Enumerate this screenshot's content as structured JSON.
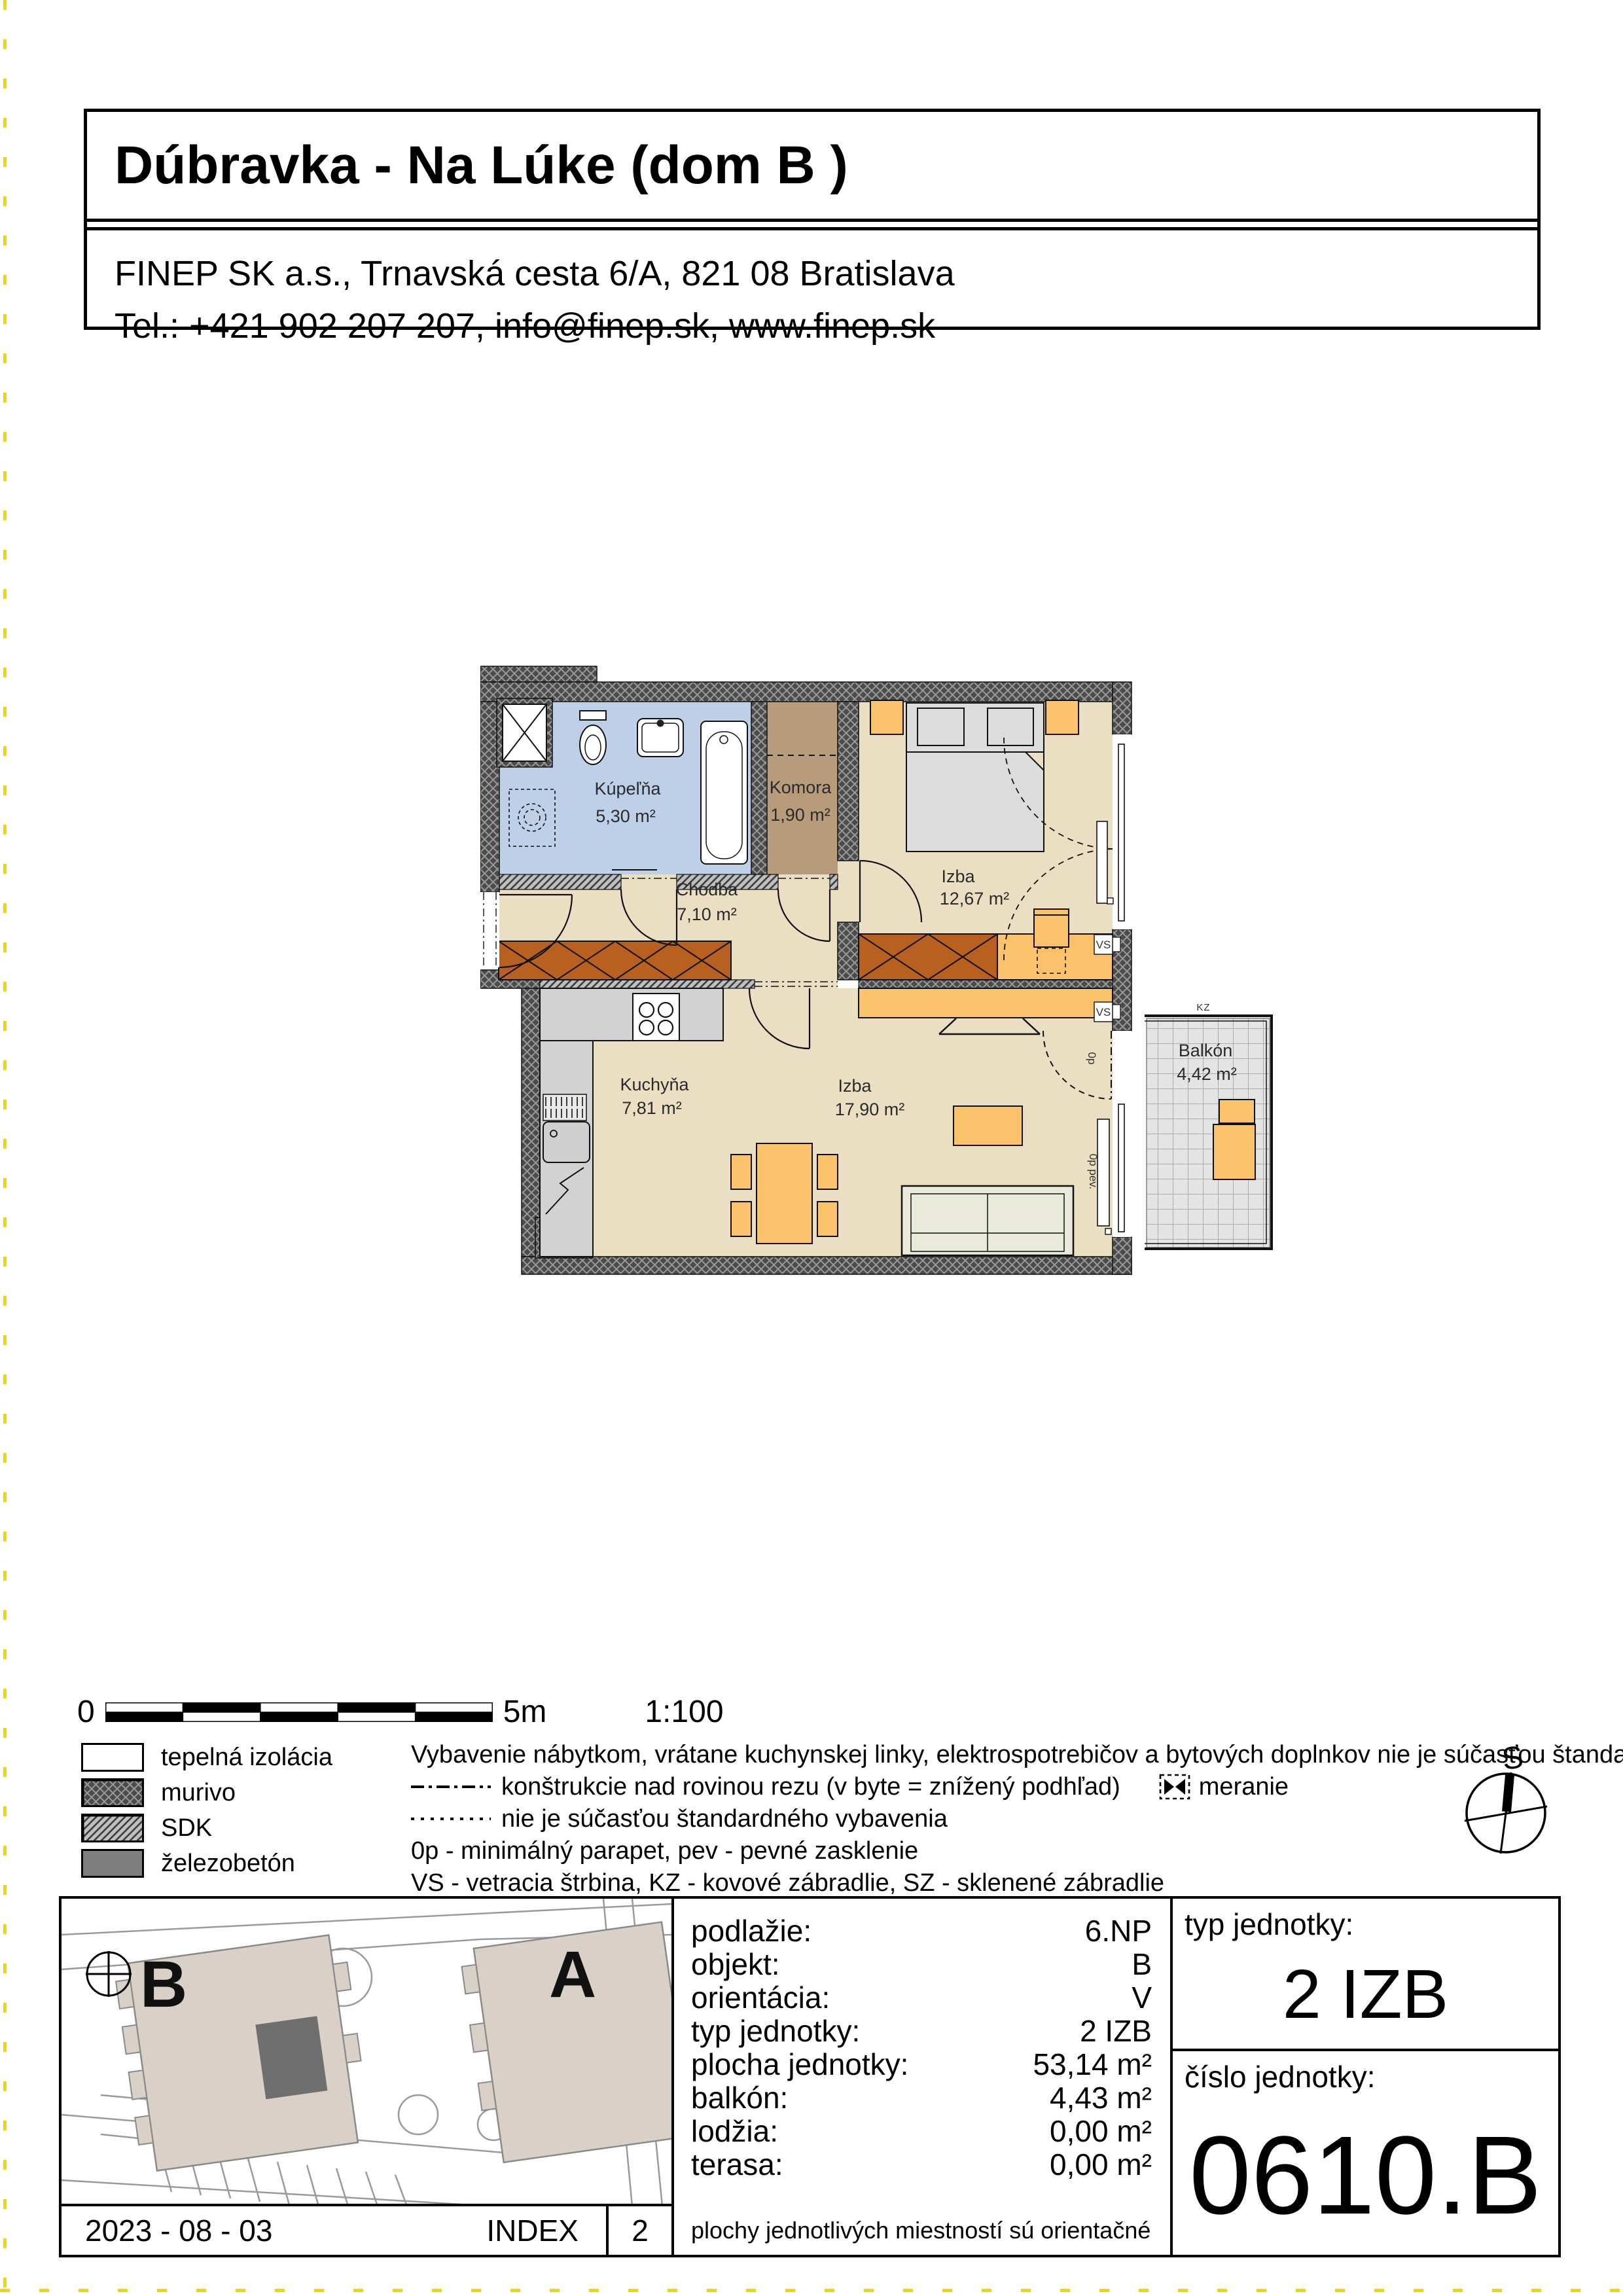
{
  "header": {
    "title": "Dúbravka - Na Lúke (dom B )",
    "address_line1": "FINEP SK a.s., Trnavská cesta 6/A, 821 08 Bratislava",
    "address_line2": "Tel.: +421 902 207 207,  info@finep.sk, www.finep.sk"
  },
  "plan": {
    "rooms": [
      {
        "name": "Kúpeľňa",
        "area": "5,30 m²"
      },
      {
        "name": "Komora",
        "area": "1,90 m²"
      },
      {
        "name": "Chodba",
        "area": "7,10 m²"
      },
      {
        "name": "Izba",
        "area": "12,67 m²"
      },
      {
        "name": "Kuchyňa",
        "area": "7,81 m²"
      },
      {
        "name": "Izba",
        "area": "17,90 m²"
      },
      {
        "name": "Balkón",
        "area": "4,42 m²"
      }
    ],
    "annotations": {
      "vs_top": "VS",
      "vs_bottom": "VS",
      "kz": "KZ",
      "op": "0p",
      "op_pev": "0p pev."
    }
  },
  "scalebar": {
    "zero": "0",
    "five": "5m",
    "ratio": "1:100"
  },
  "legend": {
    "materials": [
      {
        "label": "tepelná izolácia"
      },
      {
        "label": "murivo"
      },
      {
        "label": "SDK"
      },
      {
        "label": "železobetón"
      }
    ],
    "note_furniture": "Vybavenie nábytkom, vrátane kuchynskej linky, elektrospotrebičov a bytových doplnkov nie je súčasťou štandardného vybavenia.",
    "line_constructions": "konštrukcie nad rovinou rezu  (v byte = znížený podhľad)",
    "meranie": "meranie",
    "line_nonstandard": "nie je súčasťou štandardného vybavenia",
    "note_parapet": "0p - minimálný parapet, pev - pevné zasklenie",
    "note_abbrev": "VS - vetracia štrbina, KZ - kovové zábradlie, SZ - sklenené zábradlie"
  },
  "compass": {
    "label": "S"
  },
  "siteplan": {
    "building_b": "B",
    "building_a": "A"
  },
  "table": {
    "rows": [
      {
        "label": "podlažie:",
        "value": "6.NP"
      },
      {
        "label": "objekt:",
        "value": "B"
      },
      {
        "label": "orientácia:",
        "value": "V"
      },
      {
        "label": "typ jednotky:",
        "value": "2 IZB"
      },
      {
        "label": "plocha jednotky:",
        "value": "53,14 m²"
      },
      {
        "label": "balkón:",
        "value": "4,43 m²"
      },
      {
        "label": "lodžia:",
        "value": "0,00 m²"
      },
      {
        "label": "terasa:",
        "value": "0,00 m²"
      }
    ],
    "note": "plochy jednotlivých miestností sú orientačné",
    "unit_type_label": "typ jednotky:",
    "unit_type_value": "2 IZB",
    "unit_number_label": "číslo jednotky:",
    "unit_number_value": "0610.B"
  },
  "footer": {
    "date": "2023 - 08 - 03",
    "index_label": "INDEX",
    "index_value": "2"
  },
  "colors": {
    "wall": "#4b4b4b",
    "floor": "#ebdfc3",
    "bathroom": "#bdd0e8",
    "pantry": "#b79b7b",
    "furniture": "#f9c26b",
    "wardrobe": "#b8601f",
    "balcony_tiles": "#e4e4e4",
    "site_building": "#d9d0c8",
    "unit_highlight": "#6f6f6f",
    "edge_marks": "#eed800"
  }
}
